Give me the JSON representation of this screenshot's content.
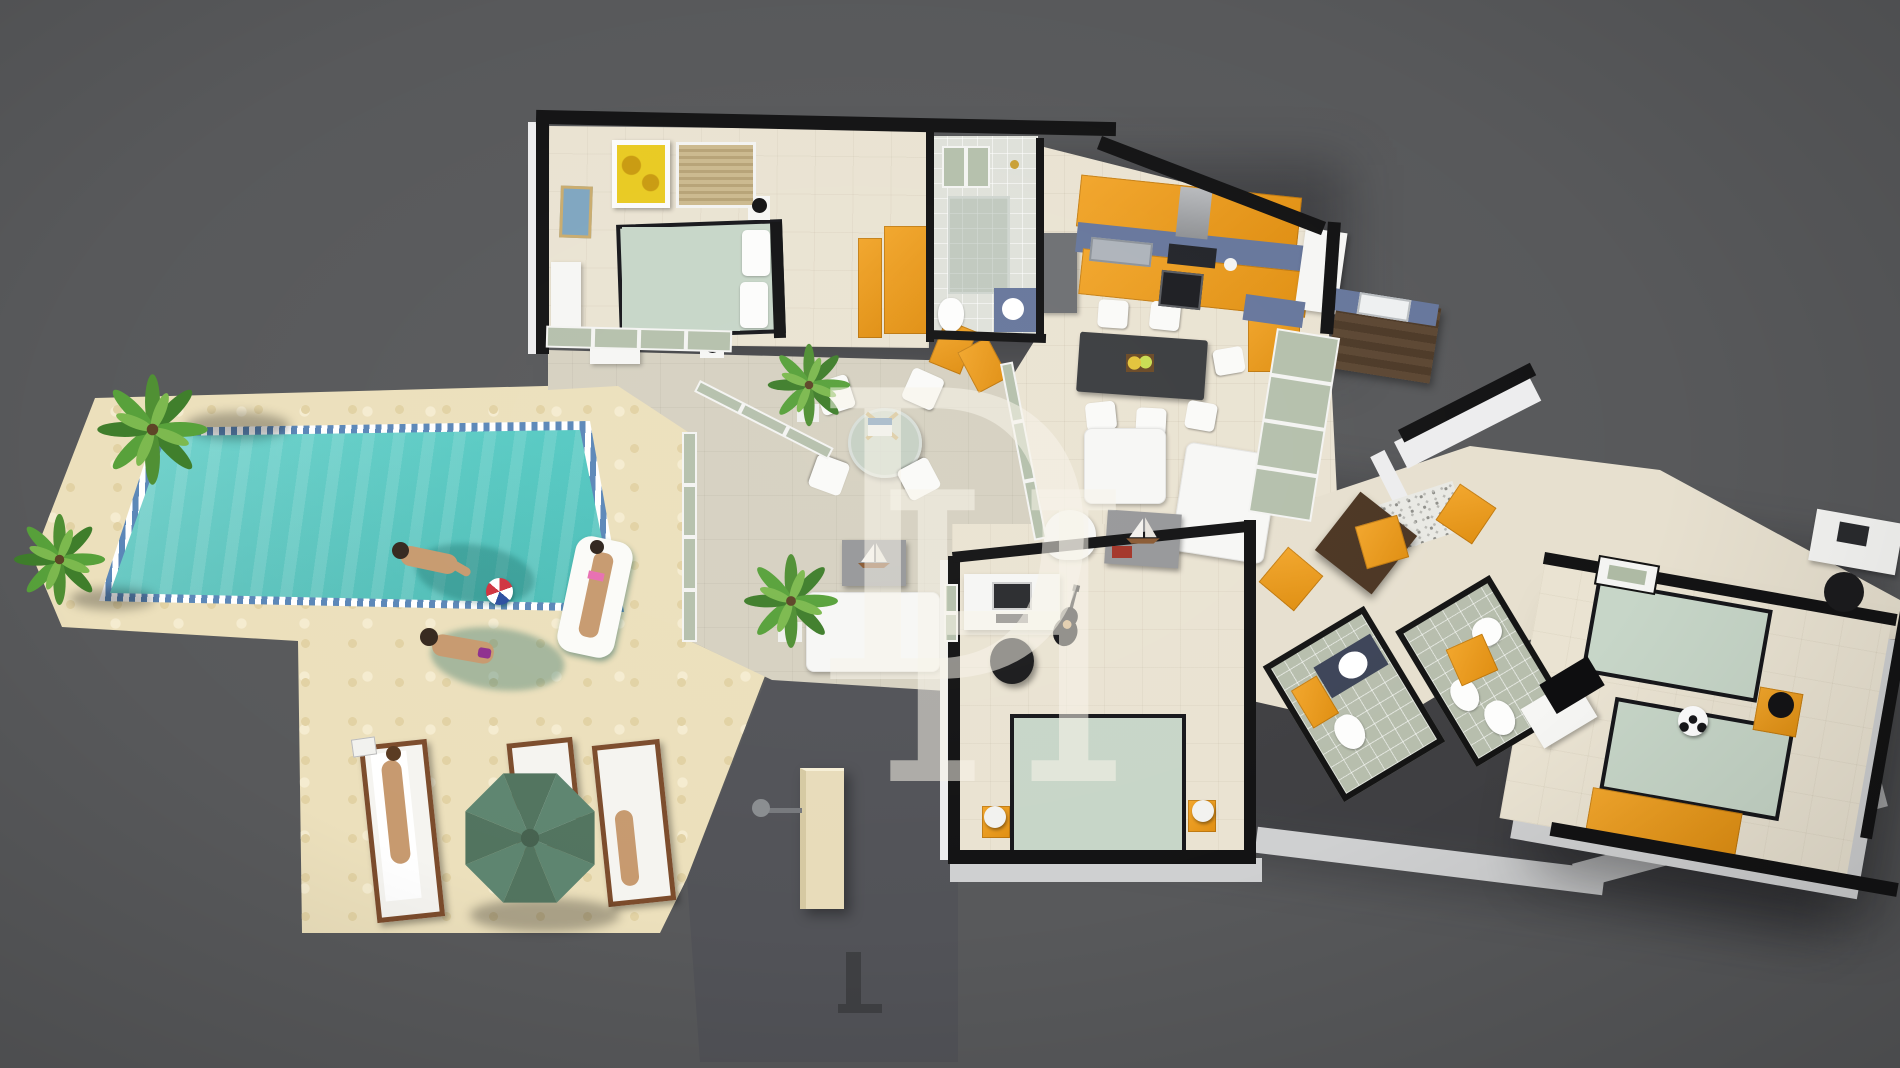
{
  "title": "3D villa floor plan render with swimming pool",
  "watermark": {
    "letter_1": "D",
    "letter_2": "H"
  },
  "palette": {
    "background": "#58595b",
    "sand_deck": "#ece0bc",
    "veranda_tile": "#d6d1c1",
    "interior_floor": "#eae3d2",
    "wall_cut": "#131314",
    "wall_face": "#ededee",
    "cabinet_orange": "#eb9d20",
    "countertop_blue": "#67779c",
    "pool_water": "#55cdc6",
    "pool_tile": "#5b87b8",
    "umbrella_green": "#5b7f68",
    "lounger_wood": "#7c4c2c",
    "duvet_sage": "#c7d6c8",
    "bath_tile": "#b7bead",
    "driveway": "#525358",
    "front_door_wood": "#4c3623",
    "beach_ball": [
      "#cf3340",
      "#ffffff",
      "#2b4fa0"
    ]
  },
  "scene": {
    "pool": {
      "swimmers": 2,
      "float_riders": 1,
      "beach_balls": 1
    },
    "deck": {
      "sun_loungers": 3,
      "umbrellas": 1,
      "palm_trees": 4,
      "sunbathers": 2
    },
    "house_rooms": [
      "master-bedroom",
      "family-bathroom",
      "kitchen",
      "dining-area",
      "living-room",
      "veranda",
      "office-bedroom",
      "ensuite-bathroom",
      "second-bathroom",
      "kids-bedroom",
      "hallway",
      "entrance-porch",
      "utility-corner"
    ]
  }
}
